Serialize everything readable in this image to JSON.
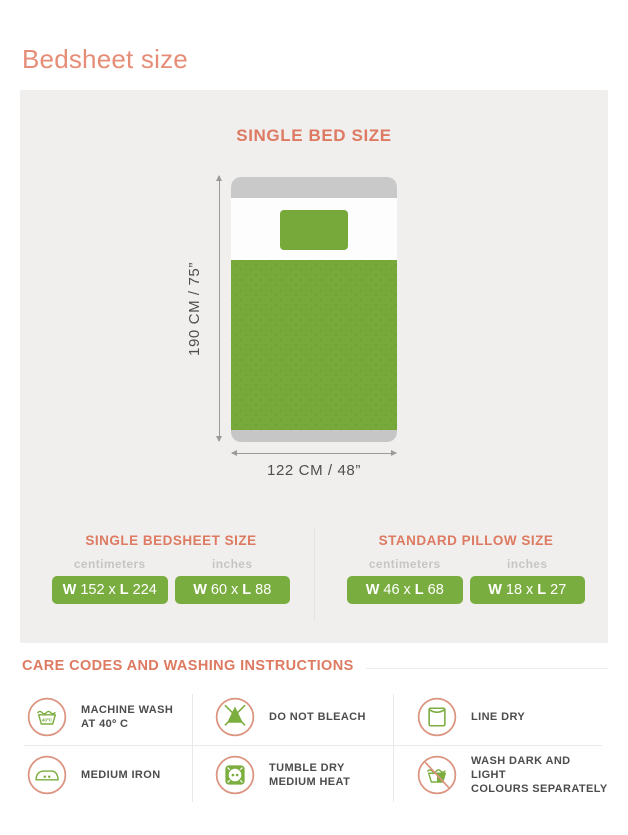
{
  "colors": {
    "coral_title": "#e68d78",
    "coral_heading": "#dd7a61",
    "coral_icon_ring": "#dc9480",
    "green": "#76a93a",
    "green_box": "#7aad3f",
    "panel_gray": "#f0efee",
    "bed_frame_gray": "#c9c9c9",
    "label_dark": "#4c4c4c"
  },
  "title": "Bedsheet size",
  "panel": {
    "heading": "SINGLE BED SIZE",
    "height_label": "190 CM / 75”",
    "width_label": "122 CM / 48”"
  },
  "tables": [
    {
      "heading": "SINGLE BEDSHEET SIZE",
      "units": [
        "centimeters",
        "inches"
      ],
      "boxes": [
        {
          "w_label": "W",
          "w": "152",
          "sep": "x",
          "l_label": "L",
          "l": "224"
        },
        {
          "w_label": "W",
          "w": "60",
          "sep": "x",
          "l_label": "L",
          "l": "88"
        }
      ]
    },
    {
      "heading": "STANDARD PILLOW SIZE",
      "units": [
        "centimeters",
        "inches"
      ],
      "boxes": [
        {
          "w_label": "W",
          "w": "46",
          "sep": "x",
          "l_label": "L",
          "l": "68"
        },
        {
          "w_label": "W",
          "w": "18",
          "sep": "x",
          "l_label": "L",
          "l": "27"
        }
      ]
    }
  ],
  "care": {
    "heading": "CARE CODES AND WASHING INSTRUCTIONS",
    "items": [
      {
        "icon": "machine-wash-icon",
        "line1": "MACHINE WASH",
        "line2": "AT  40º C",
        "badge": "40ºC"
      },
      {
        "icon": "do-not-bleach-icon",
        "line1": "DO NOT BLEACH",
        "line2": ""
      },
      {
        "icon": "line-dry-icon",
        "line1": "LINE DRY",
        "line2": ""
      },
      {
        "icon": "medium-iron-icon",
        "line1": "MEDIUM IRON",
        "line2": ""
      },
      {
        "icon": "tumble-dry-icon",
        "line1": "TUMBLE DRY",
        "line2": "MEDIUM HEAT"
      },
      {
        "icon": "wash-separately-icon",
        "line1": "WASH DARK AND LIGHT",
        "line2": "COLOURS SEPARATELY"
      }
    ]
  }
}
